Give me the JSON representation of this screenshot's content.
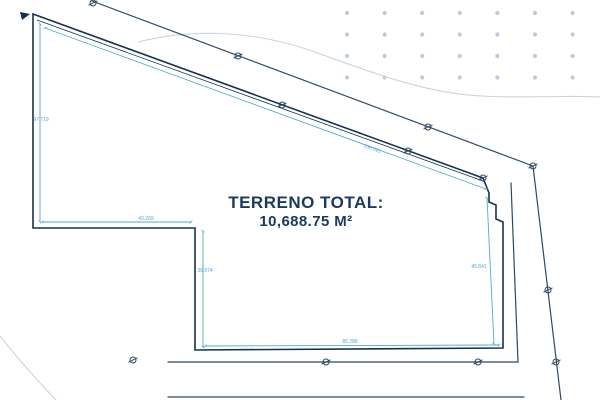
{
  "plan": {
    "title": "TERRENO TOTAL:",
    "area": "10,688.75 M²",
    "dimensions": {
      "left": "97.719",
      "top": "130.091",
      "notch_width": "43.269",
      "notch_height": "36.974",
      "bottom": "85.288",
      "right": "45.841"
    }
  },
  "icons": {
    "survey_point_icon": "circle-slash",
    "corner_arrow_icon": "small-triangle-pointer"
  },
  "colors": {
    "ink": "#16324f",
    "street": "#2e4a63",
    "dim": "#55a8cd",
    "contour": "#ccd4dc",
    "dots": "#b7cde0",
    "text": "#1c3a5c"
  },
  "decor": {
    "dot_grid": {
      "x0": 347,
      "y0": 13,
      "dx": 37.6,
      "dy": 21.5,
      "cols": 7,
      "rows": 4,
      "r": 2.1
    }
  },
  "survey_points": [
    [
      93,
      3
    ],
    [
      238,
      56
    ],
    [
      428,
      127
    ],
    [
      533,
      166
    ],
    [
      282,
      105
    ],
    [
      408,
      151
    ],
    [
      483,
      178
    ],
    [
      548,
      290
    ],
    [
      556,
      362
    ],
    [
      478,
      362
    ],
    [
      326,
      362
    ],
    [
      133,
      360
    ]
  ]
}
